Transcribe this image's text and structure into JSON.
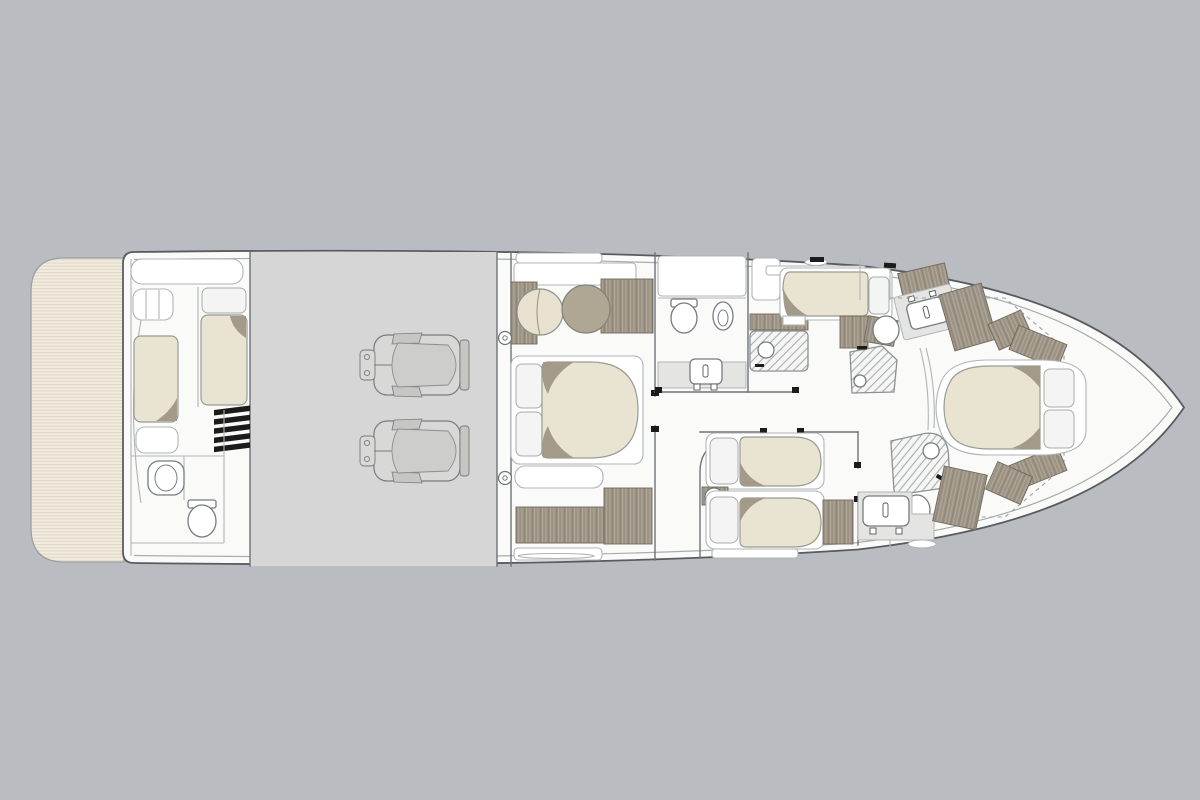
{
  "figure": {
    "kind": "yacht-lower-deck-floor-plan",
    "orientation": "bow-right"
  },
  "palette": {
    "bg": "#b9bdc1",
    "hull-fill": "#fafaf9",
    "hull-stroke": "#585c60",
    "inner-line": "#a7acaf",
    "wall": "#6e7377",
    "wall-light": "#b0b4b6",
    "engine-room": "#d5d6d5",
    "engine-body": "#d8d8d6",
    "engine-inner": "#cdcdc9",
    "engine-detail": "#c6c6c3",
    "engine-stroke": "#787c7e",
    "deck": "#f1ecdf",
    "deck-stripe": "#ded7c4",
    "deck-stroke": "#9ba0a2",
    "wood": "#9c9386",
    "wood-light": "#b2a897",
    "wood-dark": "#87806f",
    "wood-stroke": "#6f6a5c",
    "bed": "#e9e3d2",
    "bed-stroke": "#999c93",
    "fold": "#a39a89",
    "pillow": "#f3f4f3",
    "pillow-stroke": "#a8abaa",
    "fixture": "#777c7f",
    "hatch-bg": "#f6f6f5",
    "hatch-line": "#a9adb0",
    "counter": "#e4e4e2",
    "chair-beige": "#e8e1d0",
    "chair-taupe": "#b0a694",
    "black": "#1b1b1b",
    "white": "#ffffff"
  },
  "regions": [
    "swim-platform",
    "crew-quarters",
    "crew-bathroom",
    "engine-room",
    "master-cabin",
    "master-bathroom",
    "master-shower",
    "vip-mid-cabin",
    "mid-shower",
    "forward-bathroom-port",
    "bow-cabin",
    "twin-cabin",
    "forward-bathroom-starboard",
    "foredeck"
  ]
}
